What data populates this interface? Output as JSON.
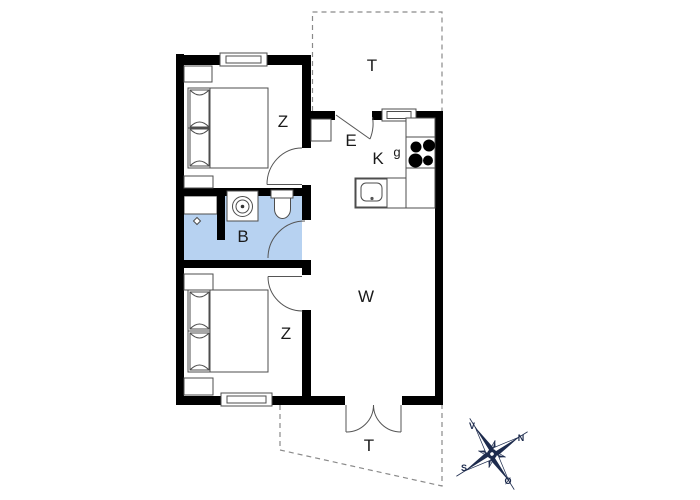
{
  "labels": {
    "bedroom_top": "Z",
    "bedroom_bottom": "Z",
    "bathroom": "B",
    "entrance": "E",
    "kitchen": "K",
    "stove": "g",
    "living_room": "W",
    "terrace_top": "T",
    "terrace_bottom": "T"
  },
  "compass": {
    "west": "V",
    "north": "N",
    "south": "S",
    "east": "Ø"
  },
  "colors": {
    "wall": "#000000",
    "bathroom_fill": "#b7d2f1",
    "thin_line": "#4d4d4d",
    "compass_navy": "#1d2b4d",
    "background": "#ffffff"
  }
}
